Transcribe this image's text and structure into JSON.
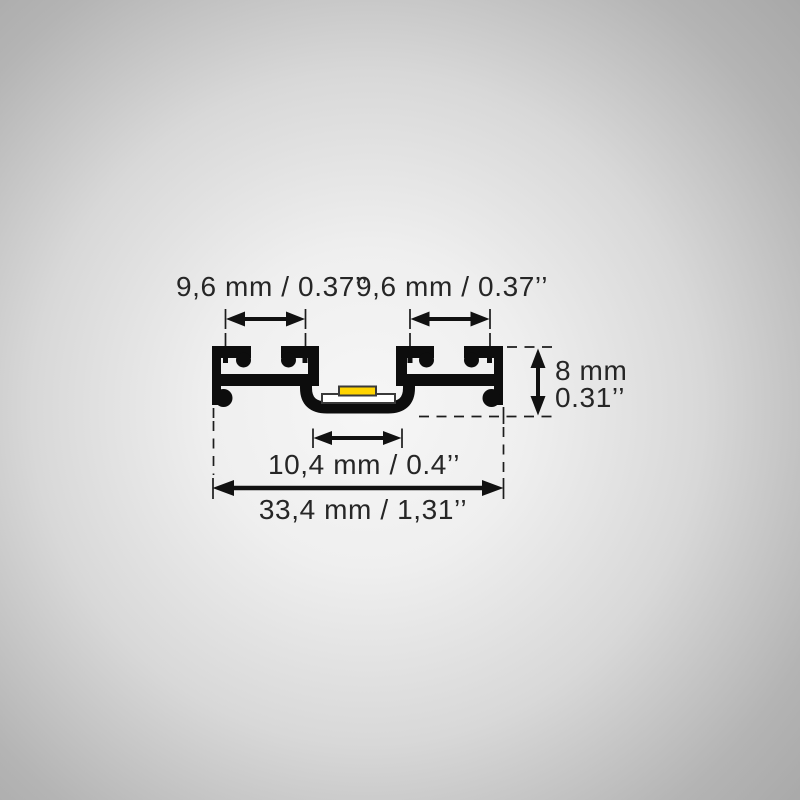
{
  "diagram": {
    "title": "LED aluminium profile cross-section dimension drawing",
    "colors": {
      "profile": "#0d0d0d",
      "pcb": "#ffffff",
      "led": "#ffd400",
      "component_outline": "#3a3a3a",
      "dimension_line": "#1c1c1c",
      "text": "#262626",
      "background_center": "#f6f6f6",
      "background_edge": "#a6a6a6"
    },
    "dimensions": {
      "slot_left": {
        "label": "9,6 mm / 0.37’’"
      },
      "slot_right": {
        "label": "9,6 mm / 0.37’’"
      },
      "height": {
        "label_mm": "8 mm",
        "label_in": "0.31’’"
      },
      "channel": {
        "label": "10,4 mm / 0.4’’"
      },
      "overall": {
        "label": "33,4 mm / 1,31’’"
      }
    }
  }
}
